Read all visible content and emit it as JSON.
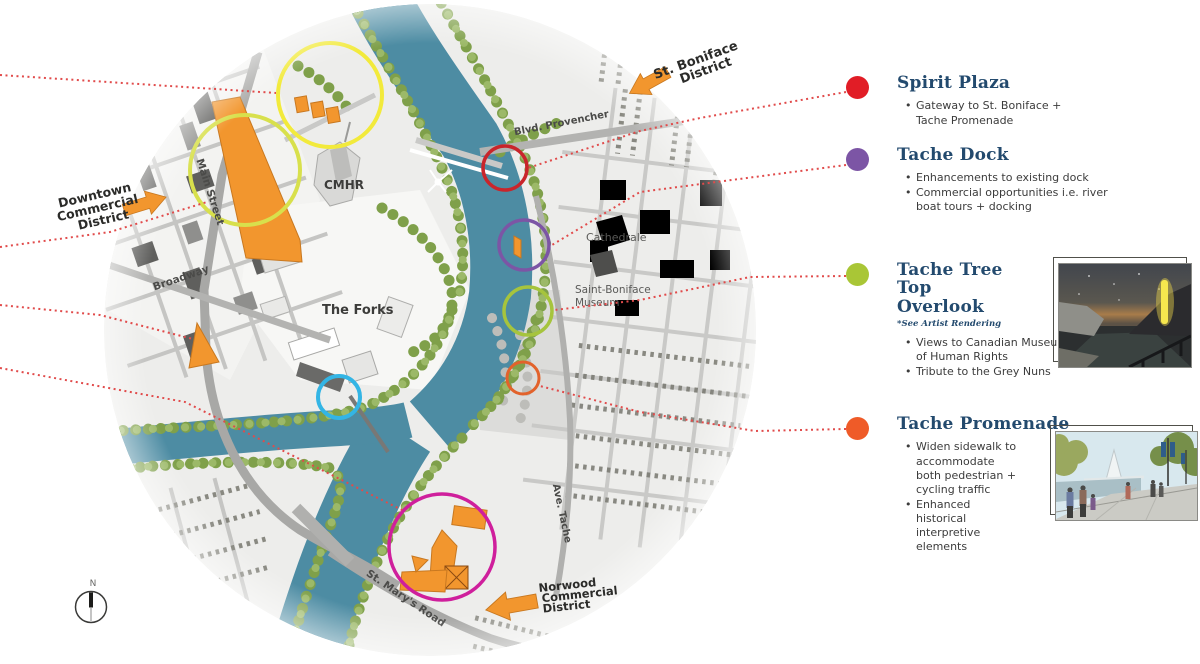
{
  "colors": {
    "accent_orange": "#f2962e",
    "leader_red": "#e14b4b",
    "river_blue": "#4d8ca3",
    "title_navy": "#234a6e",
    "marker_yellow": "#f2ea3b",
    "marker_yellowgreen": "#d8e04c",
    "marker_red": "#c9252b",
    "marker_purple": "#7c55a5",
    "marker_green": "#a6c43d",
    "marker_orangered": "#e2622b",
    "marker_cyan": "#33b5e5",
    "marker_magenta": "#cf1f9c",
    "dot_red": "#e11d26",
    "dot_purple": "#7c55a5",
    "dot_green": "#a9c636",
    "dot_orange": "#ef5b28"
  },
  "map": {
    "compass_n": "N",
    "places": {
      "cmhr": "CMHR",
      "forks": "The Forks",
      "cathedrale": "Cathedrale",
      "museum_line1": "Saint-Boniface",
      "museum_line2": "Museum"
    },
    "streets": {
      "main": "Main Street",
      "broadway": "Broadway",
      "provencher": "Blvd. Provencher",
      "tache": "Ave. Tache",
      "st_marys": "St. Mary's Road"
    },
    "districts": {
      "st_boniface": {
        "line1": "St. Boniface",
        "line2": "District"
      },
      "downtown": {
        "line1": "Downtown",
        "line2": "Commercial",
        "line3": "District"
      },
      "norwood": {
        "line1": "Norwood",
        "line2": "Commercial",
        "line3": "District"
      }
    }
  },
  "legend": {
    "items": [
      {
        "title": "Spirit Plaza",
        "bullets": [
          "Gateway to St. Boniface + Tache Promenade"
        ]
      },
      {
        "title": "Tache Dock",
        "bullets": [
          "Enhancements to existing dock",
          "Commercial opportunities i.e. river boat tours + docking"
        ]
      },
      {
        "title": "Tache Tree Top Overlook",
        "note": "*See Artist Rendering",
        "bullets": [
          "Views to Canadian Museum of Human Rights",
          "Tribute to the Grey Nuns"
        ]
      },
      {
        "title": "Tache Promenade",
        "bullets": [
          "Widen sidewalk to accommodate both pedestrian + cycling traffic",
          "Enhanced historical interpretive elements"
        ]
      }
    ]
  }
}
